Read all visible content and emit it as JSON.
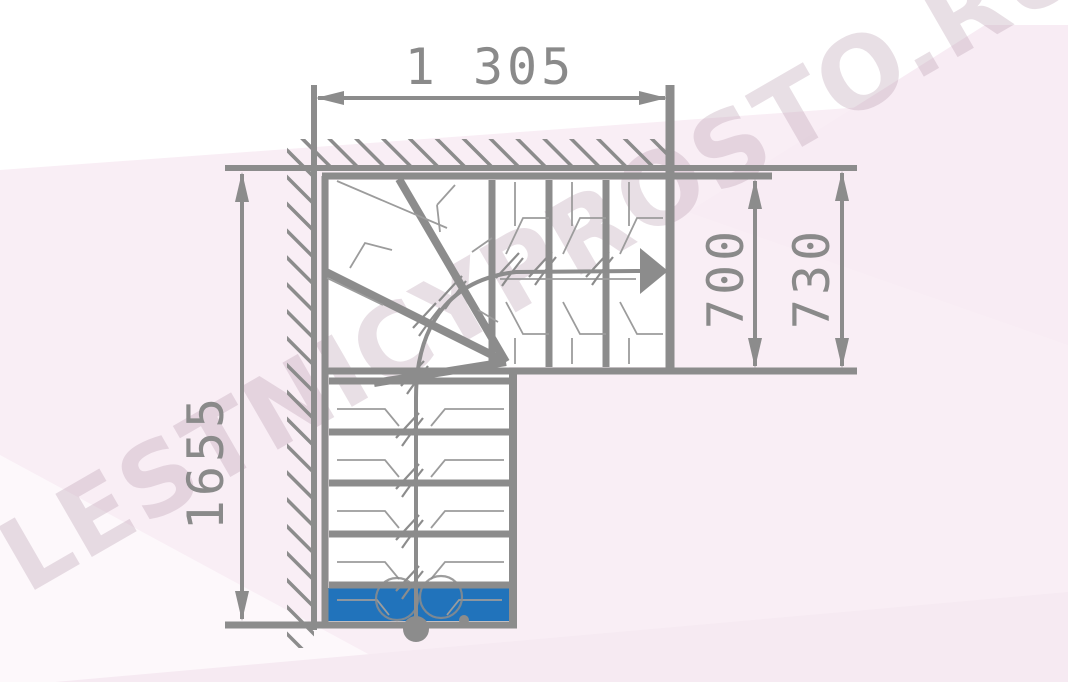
{
  "page": {
    "type": "staircase-plan-drawing",
    "description": "Top-view plan of an L-shaped staircase with winder corner steps"
  },
  "watermark": {
    "text": "LESTNICYPROSTO.RU"
  },
  "dimensions": {
    "top_width_mm": "1 305",
    "left_height_mm": "1655",
    "right_flight_mm": "700",
    "right_overall_mm": "730"
  },
  "stairs": {
    "lower_straight_treads": 5,
    "upper_straight_treads": 3,
    "winder_treads": 3,
    "first_step_highlighted": true
  },
  "colors": {
    "line_gray": "#8c8c8c",
    "thin_line_gray": "#9c9c9c",
    "first_step_blue": "#2173bb",
    "background_pink": "#f9eef5",
    "watermark_pink": "#e8d8e2"
  }
}
